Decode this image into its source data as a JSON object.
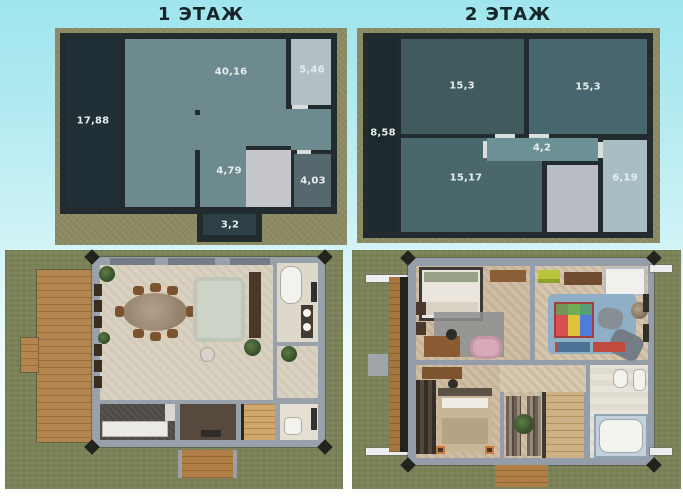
{
  "floor1": {
    "title": "1 ЭТАЖ",
    "rooms": [
      {
        "id": "left-hall",
        "area": "17,88"
      },
      {
        "id": "living",
        "area": "40,16"
      },
      {
        "id": "top-right",
        "area": "5,46"
      },
      {
        "id": "center-bottom",
        "area": "4,79"
      },
      {
        "id": "bottom-right",
        "area": "4,03"
      },
      {
        "id": "porch",
        "area": "3,2"
      }
    ]
  },
  "floor2": {
    "title": "2 ЭТАЖ",
    "rooms": [
      {
        "id": "left-strip",
        "area": "8,58"
      },
      {
        "id": "bedroom-left",
        "area": "15,3"
      },
      {
        "id": "bedroom-right",
        "area": "15,3"
      },
      {
        "id": "corridor",
        "area": "4,2"
      },
      {
        "id": "bottom-left",
        "area": "15,17"
      },
      {
        "id": "bathroom",
        "area": "6,19"
      }
    ]
  },
  "colors": {
    "background_top": "#a0e5ee",
    "background_bottom": "#ffffff",
    "site_border_khaki": "#8b8a63",
    "wall_dark": "#222b2e",
    "room_teal": "#6d8a8e",
    "room_dark_slate": "#415a5d",
    "room_light_blue": "#b2c0c5",
    "stairs_gray": "#c6c6cd",
    "door_gap": "#d9dddc",
    "grass": "#7b8157",
    "house_slab_gray": "#99a1ab",
    "floor_cream": "#d9d2c3",
    "deck_wood": "#b5854f"
  }
}
